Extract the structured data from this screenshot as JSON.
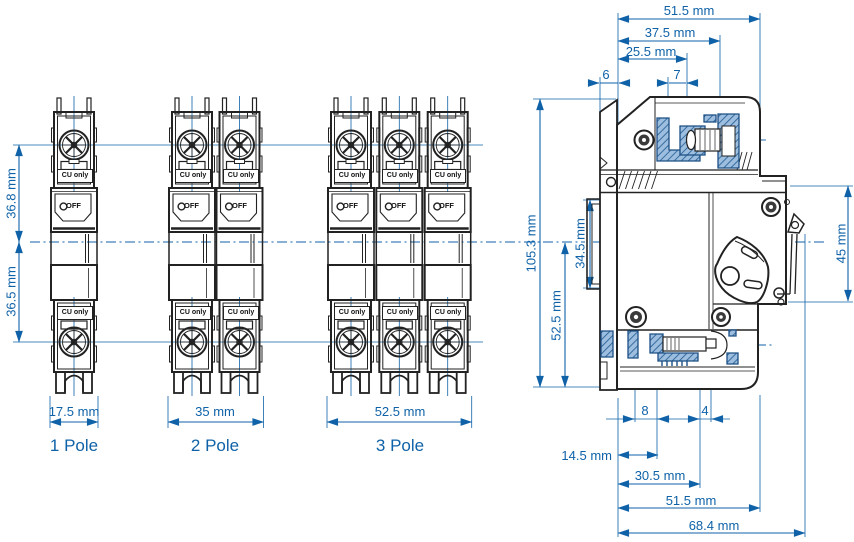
{
  "front_views": {
    "upper_height_dim": "36.8 mm",
    "lower_height_dim": "36.5 mm",
    "terminal_label": "CU only",
    "switch_state_label": "OFF",
    "breakers": [
      {
        "label": "1 Pole",
        "width_dim": "17.5 mm"
      },
      {
        "label": "2 Pole",
        "width_dim": "35 mm"
      },
      {
        "label": "3 Pole",
        "width_dim": "52.5 mm"
      }
    ]
  },
  "side_view": {
    "top": {
      "overall_51_5": "51.5 mm",
      "width_37_5": "37.5 mm",
      "width_25_5": "25.5 mm",
      "offset_6": "6",
      "offset_7": "7"
    },
    "left": {
      "height_105_3": "105.3 mm",
      "rail_34_5": "34.5 mm",
      "height_52_5": "52.5 mm"
    },
    "right": {
      "height_45": "45 mm"
    },
    "bottom": {
      "offset_8": "8",
      "offset_4": "4",
      "depth_14_5": "14.5 mm",
      "depth_30_5": "30.5 mm",
      "depth_51_5": "51.5 mm",
      "depth_68_4": "68.4 mm"
    }
  },
  "colors": {
    "dimension_blue": "#0f62a8",
    "line_ink": "#222222",
    "hatch_blue": "#9dbede"
  }
}
